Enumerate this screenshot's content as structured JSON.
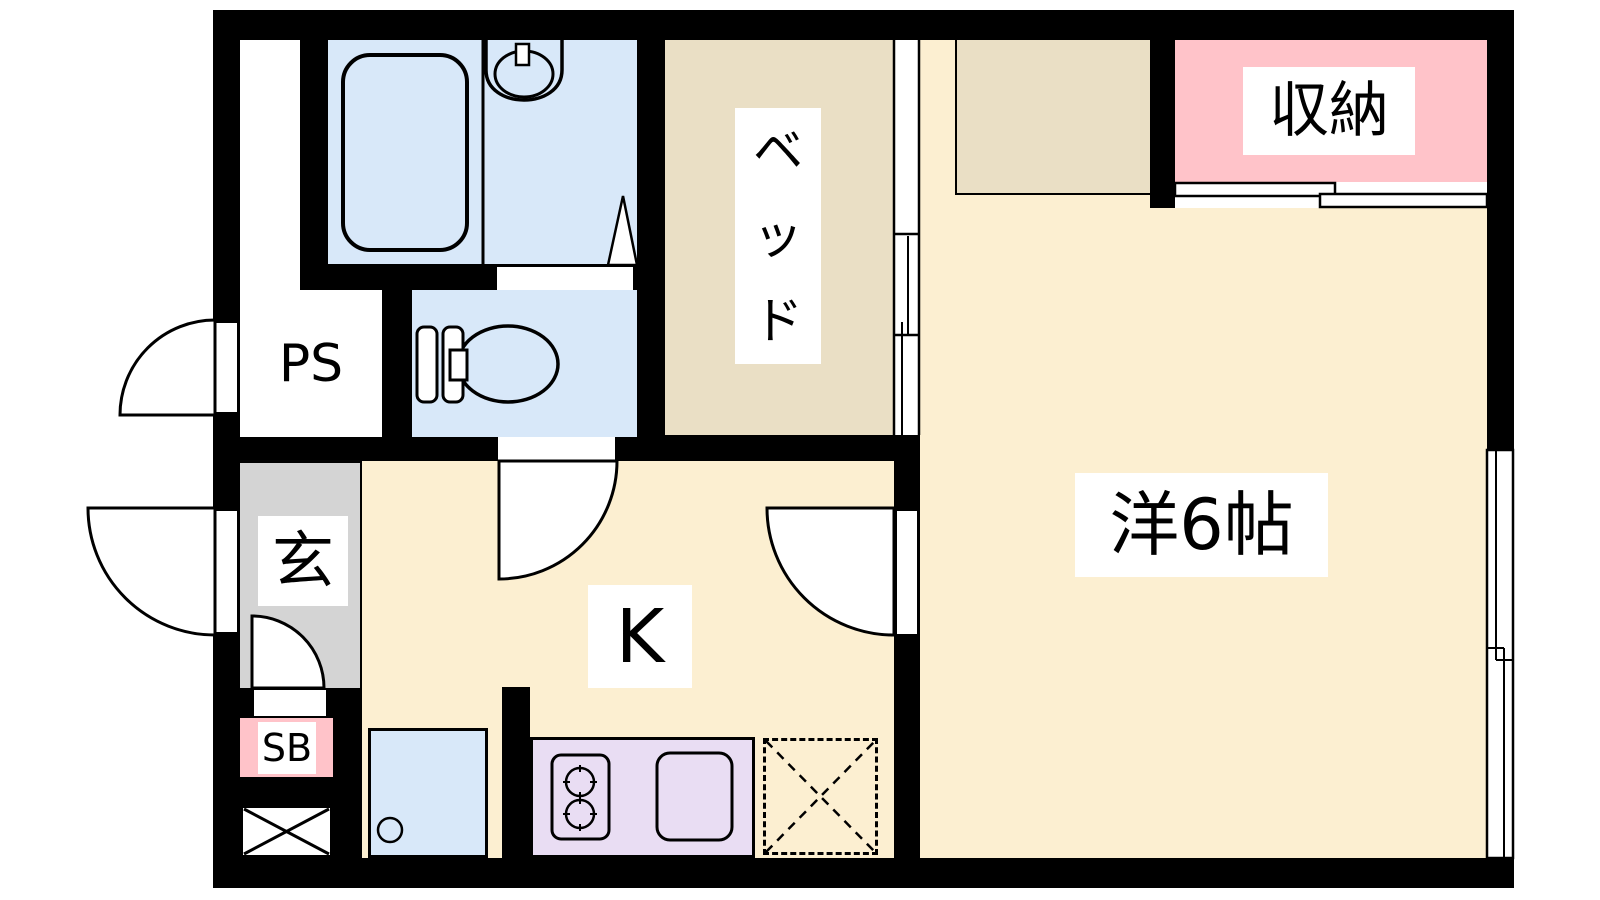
{
  "floorplan": {
    "type": "apartment-floorplan",
    "labels": {
      "pipe_space": "PS",
      "entrance": "玄",
      "shoe_box": "SB",
      "kitchen": "K",
      "bed_chars": [
        "ベ",
        "ッ",
        "ド"
      ],
      "storage": "収納",
      "western_room": "洋6帖"
    },
    "rooms": [
      {
        "id": "western-room",
        "label": "洋6帖",
        "floor": "cream"
      },
      {
        "id": "kitchen",
        "label": "K",
        "floor": "cream"
      },
      {
        "id": "bed-space",
        "label": "ベッド",
        "floor": "tan"
      },
      {
        "id": "storage-closet",
        "label": "収納",
        "floor": "pink"
      },
      {
        "id": "entrance-hall",
        "label": "玄",
        "floor": "gray"
      },
      {
        "id": "pipe-space",
        "label": "PS",
        "floor": "white"
      },
      {
        "id": "shoe-box",
        "label": "SB",
        "floor": "pink"
      },
      {
        "id": "bathroom",
        "label": "",
        "floor": "blue"
      },
      {
        "id": "toilet-room",
        "label": "",
        "floor": "blue"
      }
    ],
    "fixtures": [
      "bathtub",
      "washbasin",
      "toilet",
      "two-burner-stove",
      "kitchen-sink",
      "washing-machine-pan",
      "refrigerator-space-dashed",
      "sliding-door",
      "closet-sliding-door",
      "window",
      "hinged-door-swings"
    ],
    "colors": {
      "background": "#ffffff",
      "wall": "#000000",
      "room_cream": "#fcefd1",
      "bed_tan": "#eadfc5",
      "storage_pink": "#ffc3c9",
      "water_blue": "#d8e8f9",
      "kitchen_purple": "#e9ddf3",
      "entrance_gray": "#d4d4d4"
    }
  }
}
